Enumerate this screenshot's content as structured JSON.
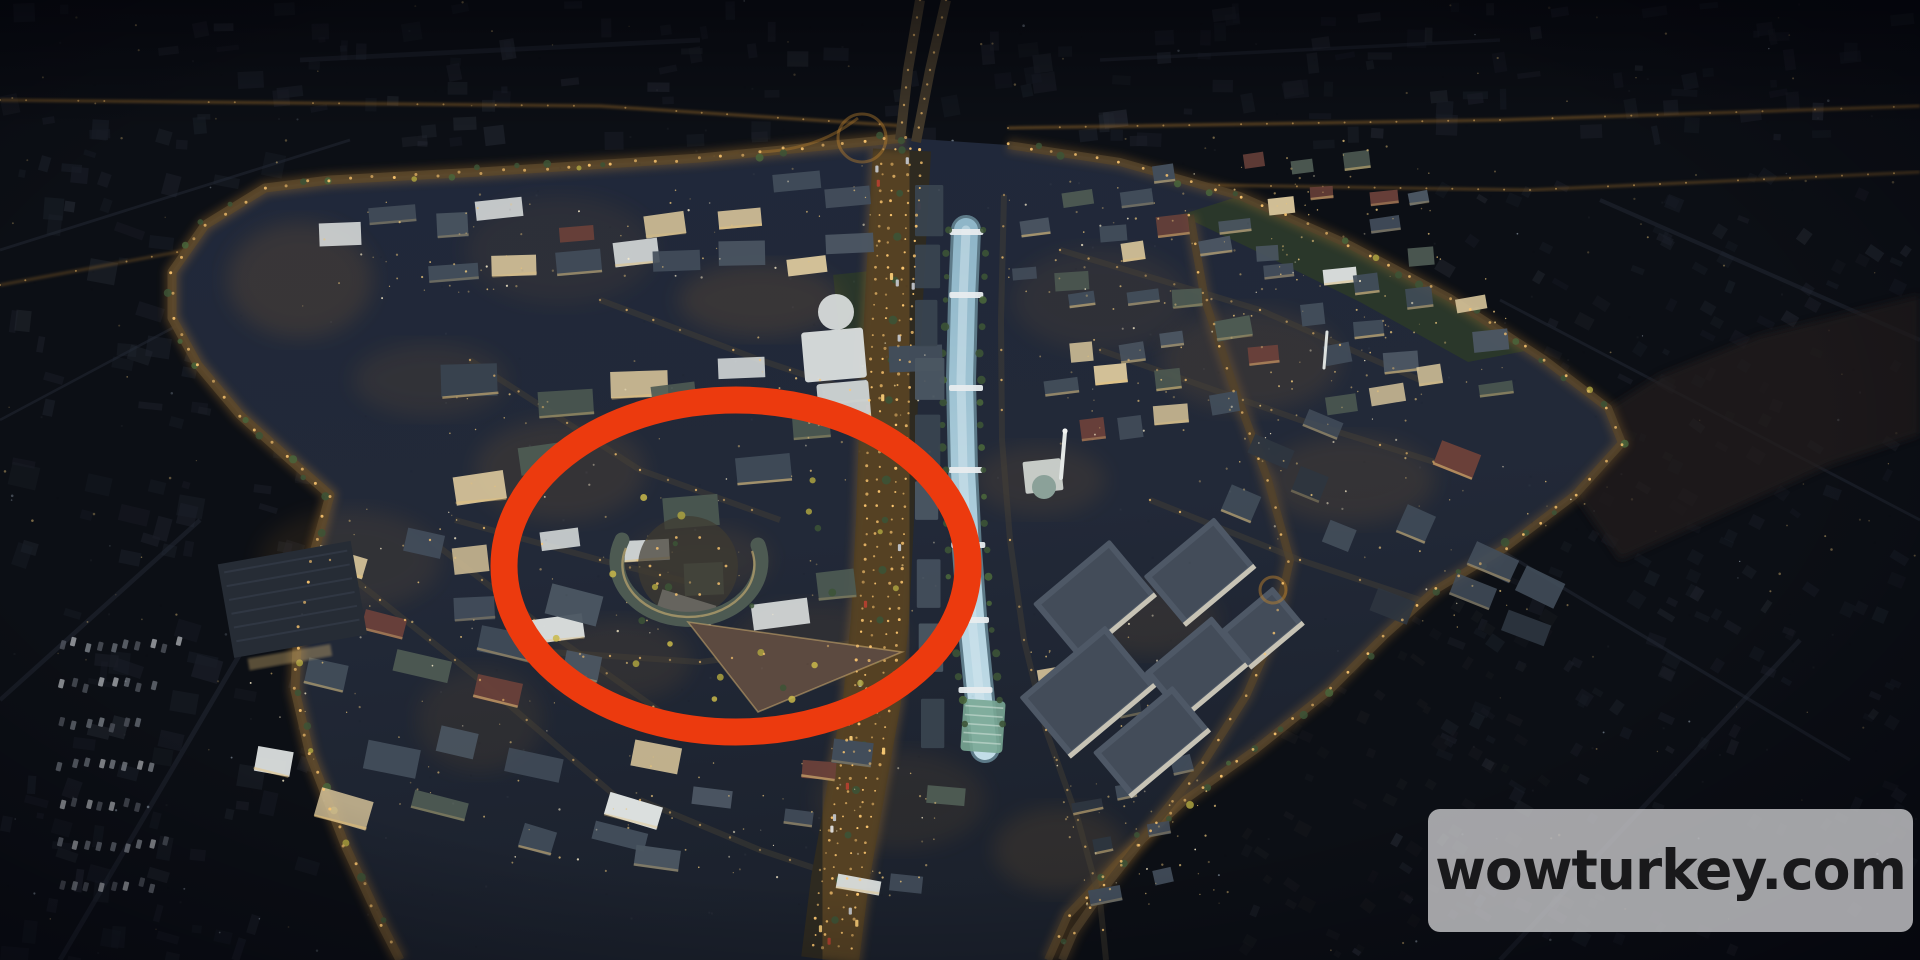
{
  "image": {
    "type": "aerial-render-night",
    "subject": "Dusk aerial rendering of an urban regeneration masterplan with a highlighted district circled in red",
    "watermark": {
      "text": "wowturkey.com",
      "bg_color": "rgba(201,201,204,0.80)",
      "text_color": "#19191b"
    },
    "annotation": {
      "shape": "ellipse",
      "cx": 736,
      "cy": 566,
      "rx": 232,
      "ry": 166,
      "stroke_width": 27,
      "color": "#ec3a0e"
    },
    "palette": {
      "background": "#0c0f15",
      "dev_ground_light": "#232a38",
      "dev_ground_dark": "#1a202b",
      "far_block": "#1a1e27",
      "far_street": "#242a35",
      "street_light": "#ffc870",
      "street_glow": "#b97f2e",
      "boulevard": "#2e2a20",
      "canal": "#a9cadb",
      "canal_highlight": "#d5e8f0",
      "bridge": "#e8ecee",
      "canopy": "#79a795",
      "tree": "#3c5336",
      "tree_autumn": "#aca23f",
      "roof_slate": "#424d5a",
      "roof_green": "#4d5a52",
      "roof_dark": "#2e3640",
      "wall_cream": "#d2c097",
      "wall_white": "#dbdfde",
      "brick": "#6b413a",
      "office_roof": "#4e5866",
      "mosque_dome": "#7b958b",
      "grass": "#2c3a28",
      "wasteland": "#221f1b",
      "window_warm": "#e9c47a",
      "window_cool": "#cfe0f0"
    }
  }
}
